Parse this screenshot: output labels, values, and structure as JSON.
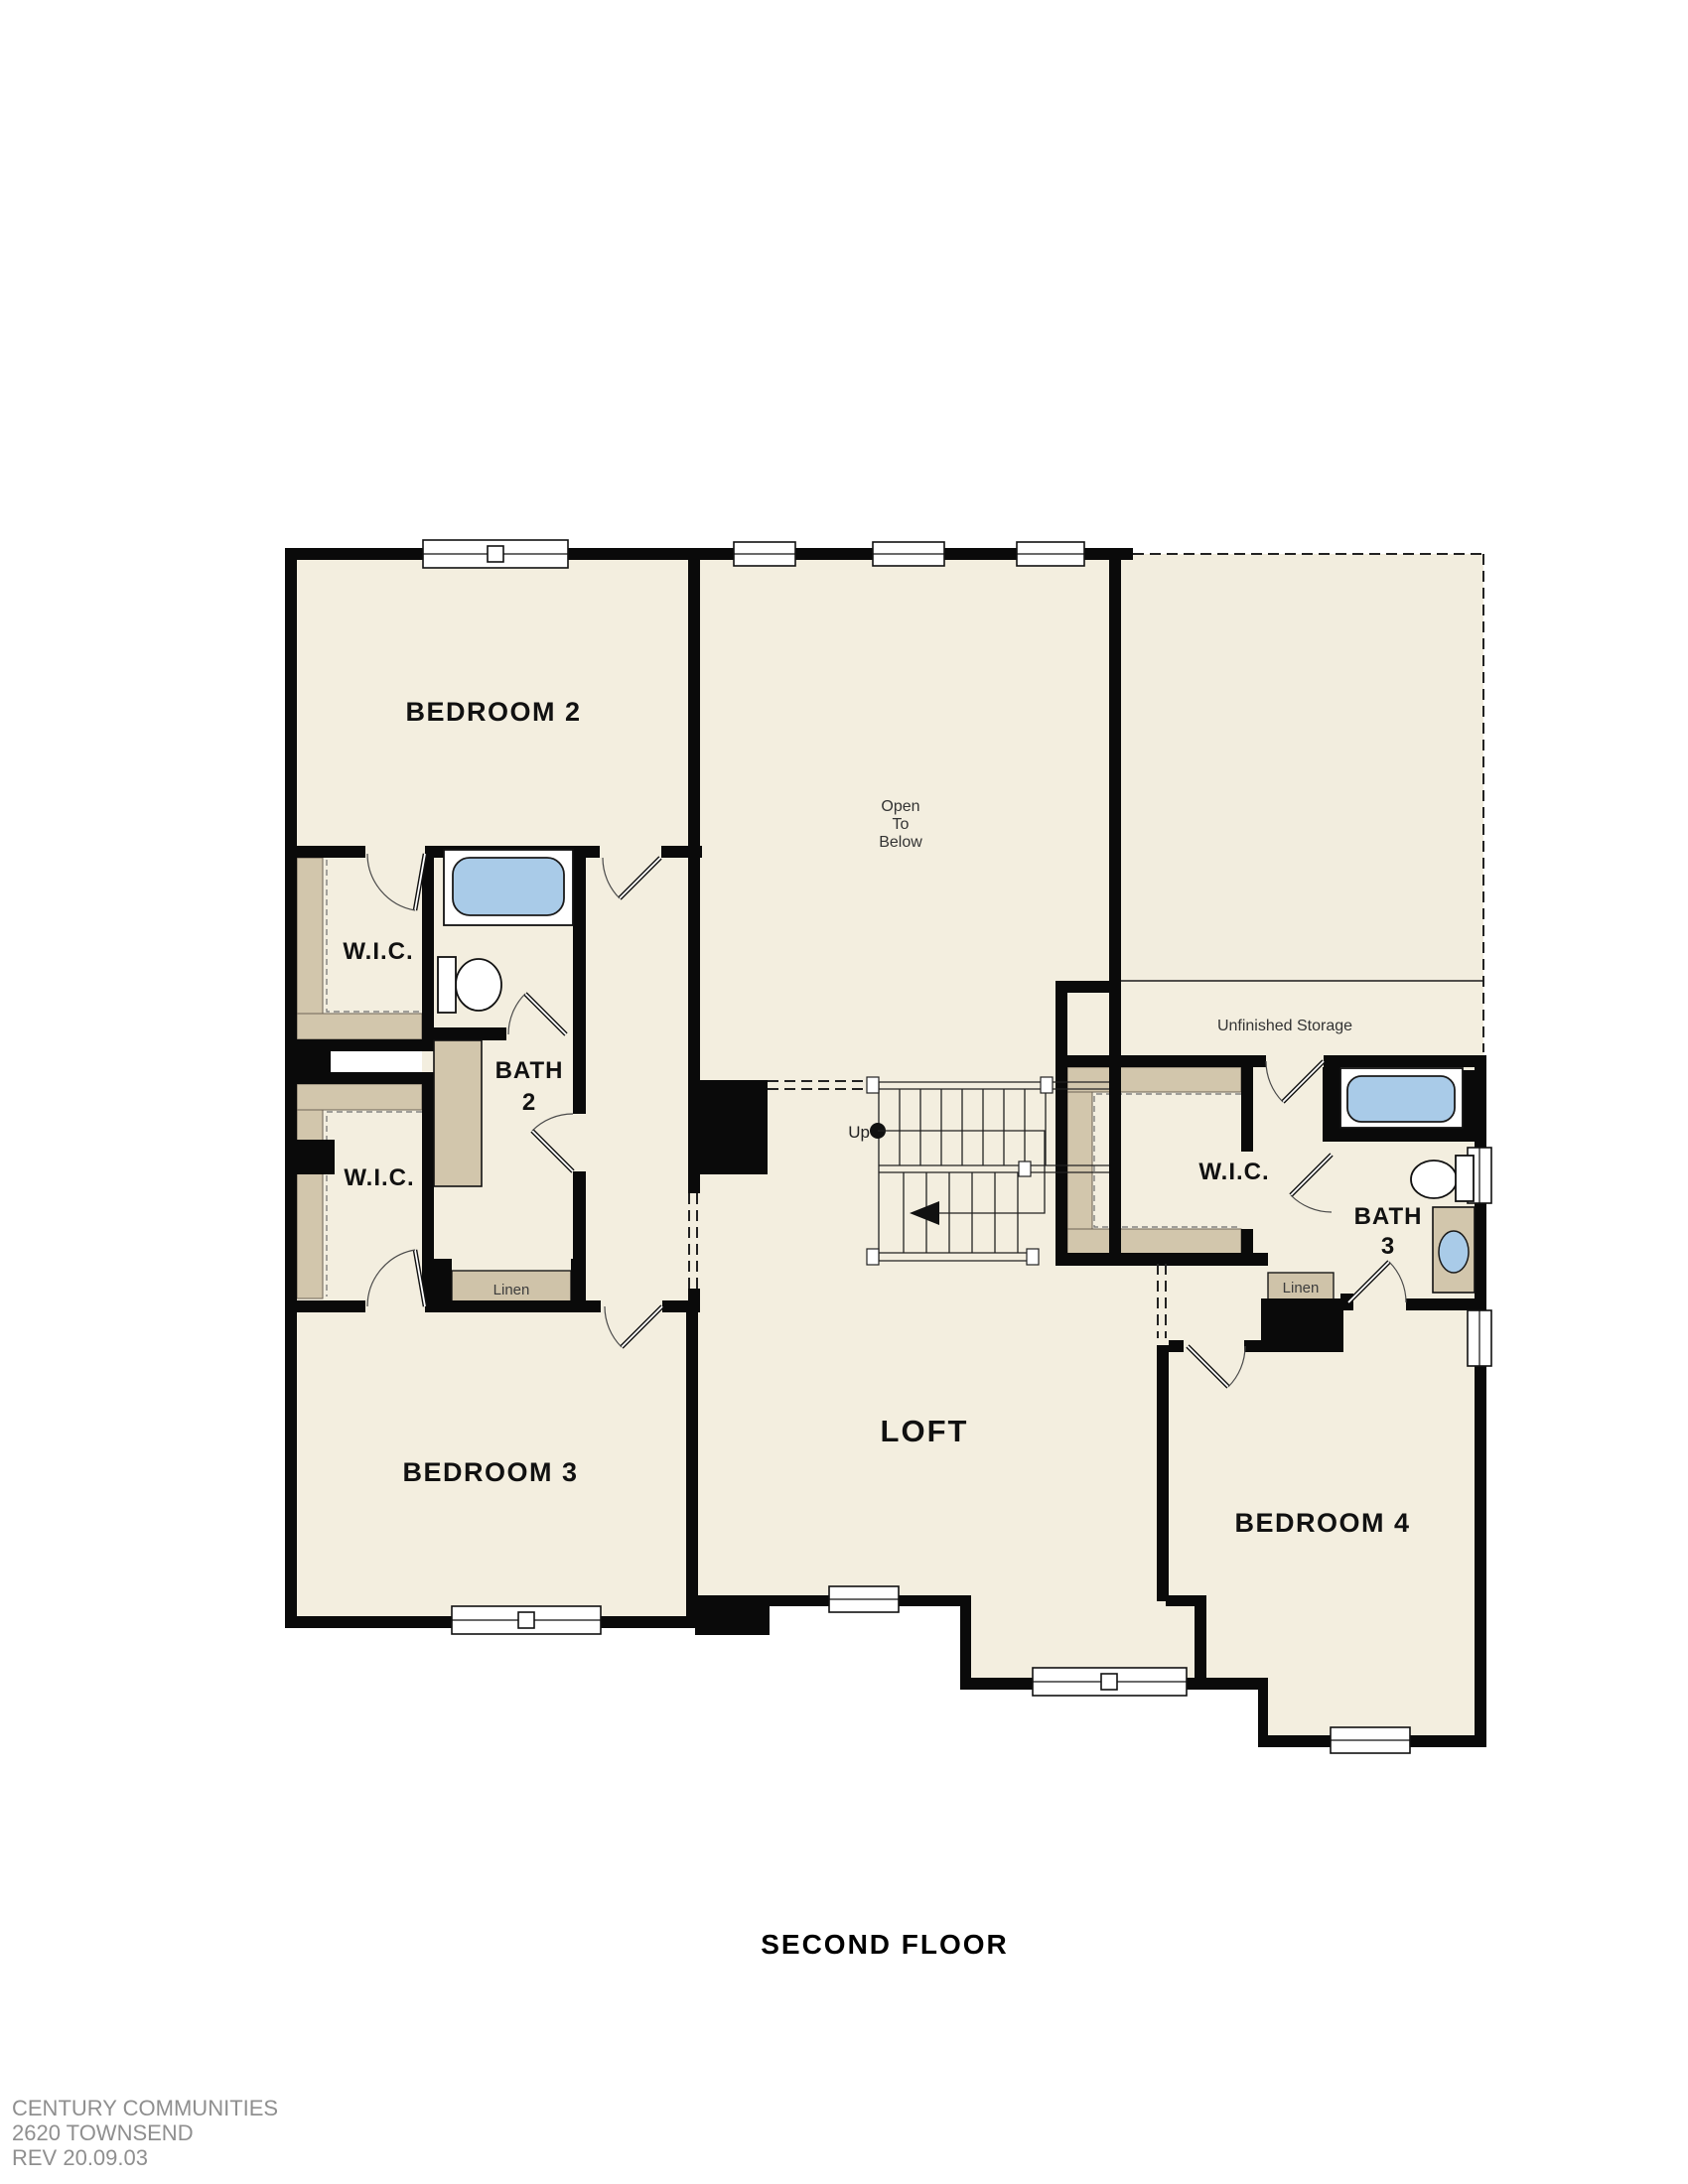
{
  "title": "SECOND FLOOR",
  "footer": {
    "line1": "CENTURY COMMUNITIES",
    "line2": "2620 TOWNSEND",
    "line3": "REV 20.09.03"
  },
  "rooms": {
    "bedroom2": "BEDROOM 2",
    "bedroom3": "BEDROOM 3",
    "bedroom4": "BEDROOM 4",
    "loft": "LOFT",
    "wic_upper_left": "W.I.C.",
    "wic_lower_left": "W.I.C.",
    "wic_right": "W.I.C.",
    "bath2_line1": "BATH",
    "bath2_line2": "2",
    "bath3_line1": "BATH",
    "bath3_line2": "3",
    "open_to_below_line1": "Open",
    "open_to_below_line2": "To",
    "open_to_below_line3": "Below",
    "unfinished_storage": "Unfinished Storage",
    "linen_left": "Linen",
    "linen_right": "Linen",
    "stairs_up": "Up"
  },
  "colors": {
    "floor_fill": "#F3EEDF",
    "closet_tan": "#D2C6AC",
    "fixture_blue": "#A9CBE8",
    "wall_black": "#0A0A0A",
    "footer_gray": "#8F8F8F"
  }
}
